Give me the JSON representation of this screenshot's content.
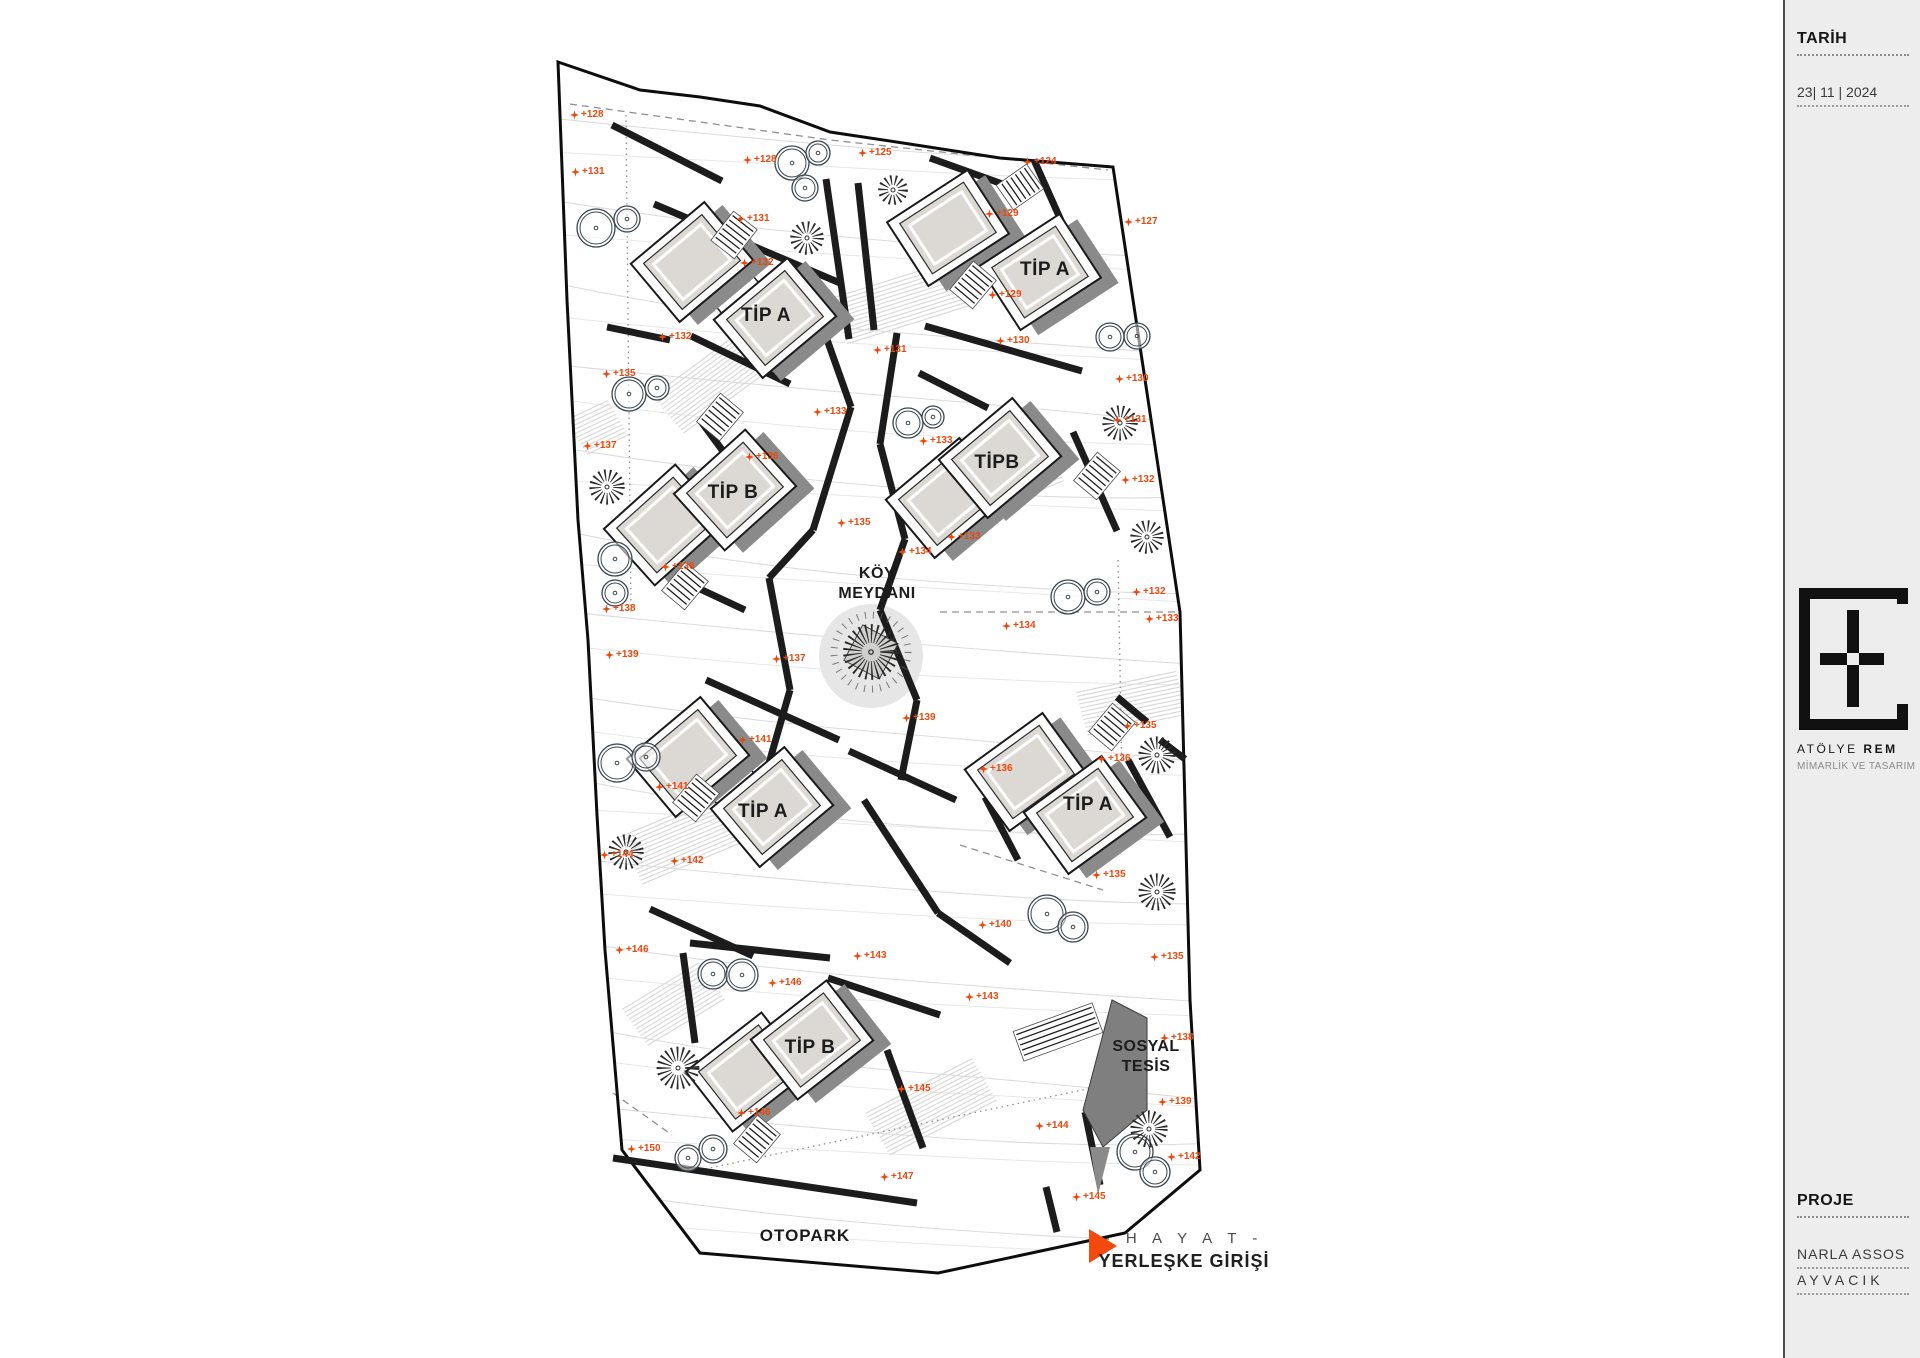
{
  "panel": {
    "tarih_label": "TARİH",
    "date": "23| 11 | 2024",
    "logo_regular": "ATÖLYE",
    "logo_bold": "REM",
    "logo_subtitle": "MİMARLİK VE TASARIM",
    "proje_label": "PROJE",
    "proje_line1": "NARLA ASSOS",
    "proje_line2": "AYVACIK",
    "bg": "#ededed",
    "accent": "#e8490f"
  },
  "plan": {
    "accent": "#e8490f",
    "koy_meydani": {
      "line1": "KÖY",
      "line2": "MEYDANI",
      "x": 877,
      "y": 584
    },
    "sosyal_tesis": {
      "line1": "SOSYAL",
      "line2": "TESİS",
      "x": 1146,
      "y": 1057
    },
    "otopark": {
      "text": "OTOPARK",
      "x": 805,
      "y": 1236
    },
    "entrance": {
      "line1": "- H A Y A T -",
      "line2": "YERLEŞKE GİRİŞİ",
      "tri_x": 1089,
      "tri_y": 1229,
      "text_x": 1184,
      "y1": 1230,
      "y2": 1251
    },
    "boundary": [
      [
        558,
        62
      ],
      [
        640,
        90
      ],
      [
        700,
        97
      ],
      [
        760,
        106
      ],
      [
        830,
        132
      ],
      [
        903,
        143
      ],
      [
        1000,
        158
      ],
      [
        1113,
        167
      ],
      [
        1180,
        612
      ],
      [
        1190,
        1000
      ],
      [
        1200,
        1170
      ],
      [
        1125,
        1233
      ],
      [
        938,
        1273
      ],
      [
        700,
        1253
      ],
      [
        622,
        1150
      ],
      [
        605,
        950
      ],
      [
        597,
        815
      ],
      [
        588,
        640
      ],
      [
        578,
        520
      ],
      [
        567,
        300
      ]
    ],
    "buildings": [
      {
        "label": "TİP A",
        "rot": -40,
        "ax": 692,
        "ay": 262,
        "bx": 775,
        "by": 318,
        "lx": 766,
        "ly": 316
      },
      {
        "label": "TİP A",
        "rot": -33,
        "ax": 948,
        "ay": 228,
        "bx": 1040,
        "by": 272,
        "lx": 1045,
        "ly": 270
      },
      {
        "label": "TİP B",
        "rot": -42,
        "ax": 665,
        "ay": 525,
        "bx": 735,
        "by": 490,
        "lx": 733,
        "ly": 493
      },
      {
        "label": "TİPB",
        "rot": -40,
        "ax": 947,
        "ay": 498,
        "bx": 1000,
        "by": 458,
        "lx": 997,
        "ly": 463
      },
      {
        "label": "TİP A",
        "rot": -40,
        "ax": 688,
        "ay": 757,
        "bx": 772,
        "by": 807,
        "lx": 763,
        "ly": 812
      },
      {
        "label": "TİP A",
        "rot": -36,
        "ax": 1026,
        "ay": 772,
        "bx": 1085,
        "by": 815,
        "lx": 1088,
        "ly": 805
      },
      {
        "label": "TİP B",
        "rot": -38,
        "ax": 747,
        "ay": 1072,
        "bx": 812,
        "by": 1040,
        "lx": 810,
        "ly": 1048
      }
    ],
    "markers": [
      {
        "t": "+128",
        "x": 575,
        "y": 115
      },
      {
        "t": "+131",
        "x": 576,
        "y": 172
      },
      {
        "t": "+128",
        "x": 748,
        "y": 160
      },
      {
        "t": "+125",
        "x": 863,
        "y": 153
      },
      {
        "t": "+124",
        "x": 1028,
        "y": 162
      },
      {
        "t": "+127",
        "x": 1129,
        "y": 222
      },
      {
        "t": "+131",
        "x": 741,
        "y": 219
      },
      {
        "t": "+132",
        "x": 745,
        "y": 263
      },
      {
        "t": "+129",
        "x": 990,
        "y": 214
      },
      {
        "t": "+129",
        "x": 993,
        "y": 295
      },
      {
        "t": "+130",
        "x": 1001,
        "y": 341
      },
      {
        "t": "+131",
        "x": 878,
        "y": 350
      },
      {
        "t": "+132",
        "x": 663,
        "y": 337
      },
      {
        "t": "+135",
        "x": 607,
        "y": 374
      },
      {
        "t": "+133",
        "x": 818,
        "y": 412
      },
      {
        "t": "+137",
        "x": 588,
        "y": 446
      },
      {
        "t": "+136",
        "x": 750,
        "y": 457
      },
      {
        "t": "+135",
        "x": 842,
        "y": 523
      },
      {
        "t": "+136",
        "x": 666,
        "y": 567
      },
      {
        "t": "+138",
        "x": 607,
        "y": 609
      },
      {
        "t": "+130",
        "x": 1120,
        "y": 379
      },
      {
        "t": "+131",
        "x": 1118,
        "y": 420
      },
      {
        "t": "+133",
        "x": 924,
        "y": 441
      },
      {
        "t": "+132",
        "x": 1126,
        "y": 480
      },
      {
        "t": "+133",
        "x": 952,
        "y": 537
      },
      {
        "t": "+134",
        "x": 903,
        "y": 552
      },
      {
        "t": "+132",
        "x": 1137,
        "y": 592
      },
      {
        "t": "+133",
        "x": 1150,
        "y": 619
      },
      {
        "t": "+134",
        "x": 1007,
        "y": 626
      },
      {
        "t": "+135",
        "x": 1128,
        "y": 726
      },
      {
        "t": "+136",
        "x": 1102,
        "y": 759
      },
      {
        "t": "+136",
        "x": 984,
        "y": 769
      },
      {
        "t": "+139",
        "x": 907,
        "y": 718
      },
      {
        "t": "+139",
        "x": 610,
        "y": 655
      },
      {
        "t": "+137",
        "x": 777,
        "y": 659
      },
      {
        "t": "+141",
        "x": 743,
        "y": 740
      },
      {
        "t": "+141",
        "x": 660,
        "y": 787
      },
      {
        "t": "+144",
        "x": 605,
        "y": 855
      },
      {
        "t": "+142",
        "x": 675,
        "y": 861
      },
      {
        "t": "+140",
        "x": 983,
        "y": 925
      },
      {
        "t": "+135",
        "x": 1097,
        "y": 875
      },
      {
        "t": "+135",
        "x": 1155,
        "y": 957
      },
      {
        "t": "+143",
        "x": 970,
        "y": 997
      },
      {
        "t": "+146",
        "x": 620,
        "y": 950
      },
      {
        "t": "+143",
        "x": 858,
        "y": 956
      },
      {
        "t": "+146",
        "x": 773,
        "y": 983
      },
      {
        "t": "+145",
        "x": 902,
        "y": 1089
      },
      {
        "t": "+146",
        "x": 742,
        "y": 1113
      },
      {
        "t": "+150",
        "x": 632,
        "y": 1149
      },
      {
        "t": "+147",
        "x": 885,
        "y": 1177
      },
      {
        "t": "+138",
        "x": 1165,
        "y": 1038
      },
      {
        "t": "+139",
        "x": 1163,
        "y": 1102
      },
      {
        "t": "+144",
        "x": 1040,
        "y": 1126
      },
      {
        "t": "+142",
        "x": 1172,
        "y": 1157
      },
      {
        "t": "+145",
        "x": 1077,
        "y": 1197
      }
    ],
    "walls": [
      [
        612,
        125,
        722,
        181
      ],
      [
        654,
        204,
        840,
        283
      ],
      [
        826,
        179,
        849,
        339
      ],
      [
        858,
        183,
        874,
        330
      ],
      [
        930,
        158,
        1008,
        186
      ],
      [
        1034,
        160,
        1076,
        254
      ],
      [
        925,
        326,
        1082,
        371
      ],
      [
        919,
        373,
        988,
        408
      ],
      [
        897,
        333,
        880,
        444
      ],
      [
        880,
        444,
        905,
        539
      ],
      [
        905,
        539,
        880,
        610
      ],
      [
        880,
        610,
        917,
        700
      ],
      [
        917,
        700,
        901,
        780
      ],
      [
        808,
        286,
        851,
        407
      ],
      [
        851,
        407,
        813,
        530
      ],
      [
        813,
        530,
        769,
        578
      ],
      [
        769,
        578,
        790,
        690
      ],
      [
        790,
        690,
        765,
        777
      ],
      [
        691,
        336,
        790,
        384
      ],
      [
        700,
        420,
        759,
        500
      ],
      [
        640,
        561,
        745,
        610
      ],
      [
        607,
        327,
        670,
        340
      ],
      [
        1073,
        432,
        1117,
        531
      ],
      [
        706,
        680,
        839,
        740
      ],
      [
        849,
        751,
        956,
        800
      ],
      [
        864,
        800,
        938,
        913
      ],
      [
        938,
        913,
        1010,
        963
      ],
      [
        650,
        909,
        753,
        956
      ],
      [
        985,
        797,
        1018,
        860
      ],
      [
        1128,
        760,
        1170,
        837
      ],
      [
        1117,
        697,
        1147,
        722
      ],
      [
        1160,
        740,
        1185,
        759
      ],
      [
        690,
        943,
        830,
        958
      ],
      [
        828,
        978,
        940,
        1015
      ],
      [
        683,
        953,
        695,
        1043
      ],
      [
        613,
        1158,
        917,
        1203
      ],
      [
        887,
        1050,
        923,
        1148
      ],
      [
        1085,
        1112,
        1100,
        1185
      ],
      [
        1046,
        1187,
        1057,
        1232
      ]
    ],
    "stairs": [
      [
        734,
        235,
        38
      ],
      [
        1020,
        187,
        55
      ],
      [
        973,
        285,
        40
      ],
      [
        720,
        417,
        40
      ],
      [
        685,
        586,
        40
      ],
      [
        1097,
        476,
        40
      ],
      [
        696,
        798,
        40
      ],
      [
        1112,
        727,
        40
      ],
      [
        757,
        1139,
        40
      ]
    ],
    "ramp": {
      "x": 1058,
      "y": 1032,
      "rot": -20
    },
    "trees_circle": [
      [
        596,
        228,
        19
      ],
      [
        627,
        219,
        13
      ],
      [
        792,
        163,
        17
      ],
      [
        818,
        153,
        12
      ],
      [
        805,
        188,
        13
      ],
      [
        1110,
        337,
        14
      ],
      [
        1137,
        336,
        13
      ],
      [
        908,
        423,
        15
      ],
      [
        933,
        417,
        11
      ],
      [
        629,
        394,
        17
      ],
      [
        657,
        388,
        12
      ],
      [
        615,
        559,
        17
      ],
      [
        615,
        593,
        13
      ],
      [
        1068,
        597,
        17
      ],
      [
        1097,
        592,
        13
      ],
      [
        617,
        763,
        19
      ],
      [
        646,
        757,
        14
      ],
      [
        713,
        974,
        15
      ],
      [
        742,
        975,
        16
      ],
      [
        688,
        1158,
        13
      ],
      [
        713,
        1149,
        14
      ],
      [
        1135,
        1152,
        18
      ],
      [
        1155,
        1172,
        15
      ],
      [
        1047,
        914,
        19
      ],
      [
        1073,
        927,
        15
      ]
    ],
    "trees_radial": [
      [
        807,
        238,
        18
      ],
      [
        893,
        190,
        16
      ],
      [
        1120,
        423,
        19
      ],
      [
        1147,
        537,
        18
      ],
      [
        607,
        487,
        19
      ],
      [
        1157,
        755,
        20
      ],
      [
        1157,
        892,
        20
      ],
      [
        626,
        852,
        19
      ],
      [
        678,
        1068,
        23
      ],
      [
        1149,
        1129,
        20
      ]
    ],
    "plaza": {
      "x": 871,
      "y": 652,
      "r": 30
    },
    "sosyal_roof": [
      [
        1112,
        1000
      ],
      [
        1147,
        1018
      ],
      [
        1147,
        1110
      ],
      [
        1103,
        1147
      ],
      [
        1083,
        1110
      ]
    ],
    "sosyal_tail": [
      [
        1090,
        1147
      ],
      [
        1110,
        1147
      ],
      [
        1098,
        1195
      ]
    ],
    "dashes": [
      {
        "pts": [
          [
            570,
            104
          ],
          [
            830,
            140
          ],
          [
            1108,
            170
          ]
        ],
        "dot": false
      },
      {
        "pts": [
          [
            626,
            115
          ],
          [
            631,
            614
          ]
        ],
        "dot": true
      },
      {
        "pts": [
          [
            1118,
            560
          ],
          [
            1123,
            830
          ]
        ],
        "dot": true
      },
      {
        "pts": [
          [
            940,
            612
          ],
          [
            1180,
            612
          ]
        ],
        "dot": false
      },
      {
        "pts": [
          [
            960,
            845
          ],
          [
            1103,
            890
          ]
        ],
        "dot": false
      },
      {
        "pts": [
          [
            613,
            1093
          ],
          [
            672,
            1135
          ]
        ],
        "dot": false
      },
      {
        "pts": [
          [
            700,
            1170
          ],
          [
            1130,
            1080
          ]
        ],
        "dot": true
      }
    ],
    "hatches": [
      [
        900,
        300,
        130,
        50,
        -20
      ],
      [
        705,
        385,
        95,
        50,
        -40
      ],
      [
        1000,
        480,
        115,
        45,
        -25
      ],
      [
        700,
        830,
        150,
        55,
        -25
      ],
      [
        672,
        1002,
        90,
        45,
        -35
      ],
      [
        1135,
        700,
        110,
        45,
        -15
      ],
      [
        930,
        1105,
        120,
        50,
        -30
      ],
      [
        585,
        430,
        70,
        40,
        -30
      ]
    ],
    "colors": {
      "boundary": "#0d0d0d",
      "wall": "#1c1c1c",
      "roof": "#dcd9d4",
      "shadow": "#8a8a8a",
      "contour": "#dcdcdc",
      "tree": "#39464e",
      "sosyal": "#7f7f7f"
    }
  }
}
